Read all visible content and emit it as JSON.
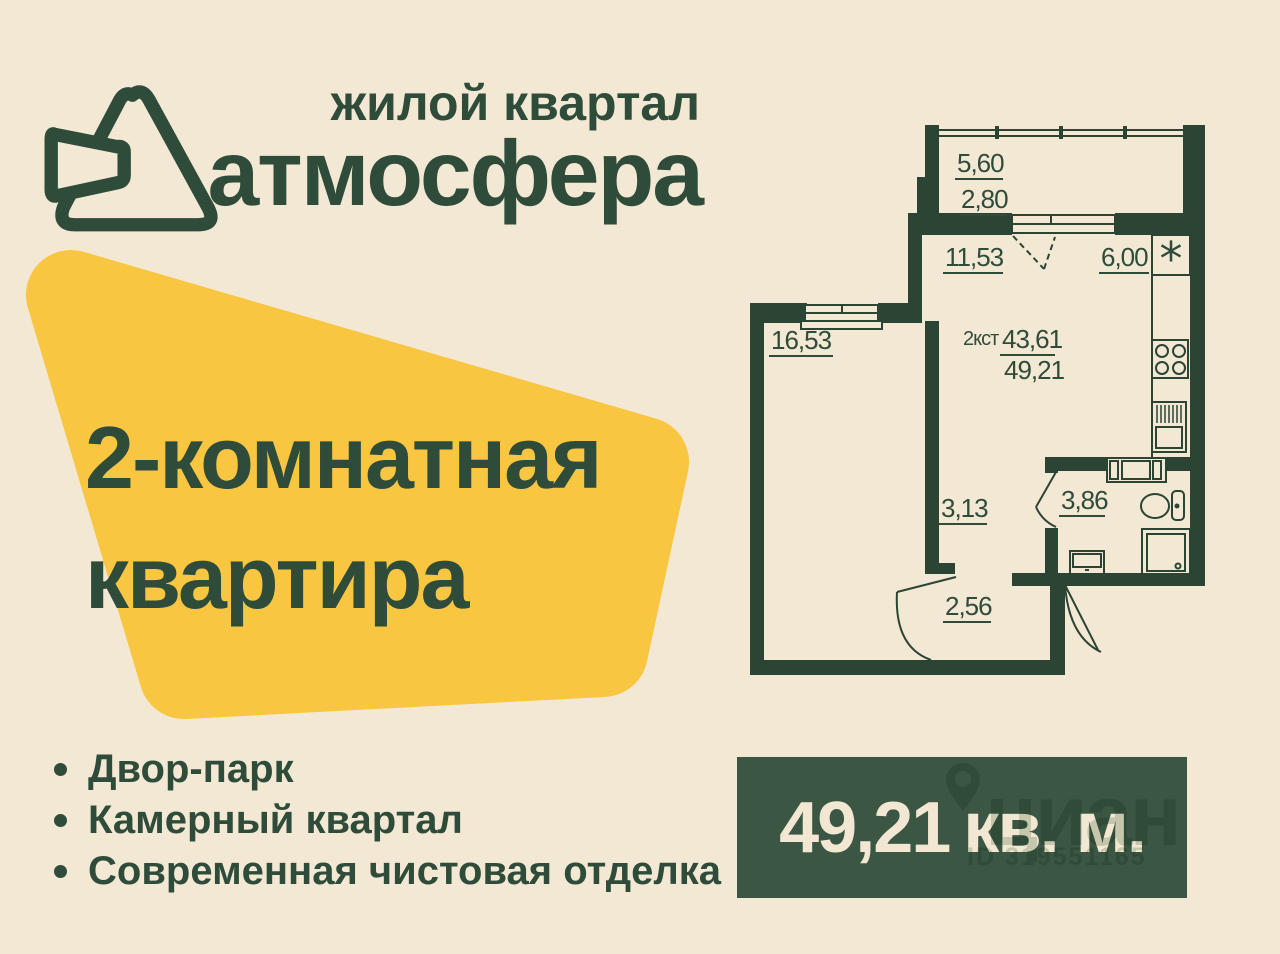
{
  "page": {
    "background": "#f2e8d4",
    "ink": "#2f4b3a"
  },
  "brand": {
    "tagline": "жилой квартал",
    "name": "атмосфера"
  },
  "offer_badge": {
    "color": "#f8c640",
    "line1": "2-комнатная",
    "line2": "квартира"
  },
  "features": {
    "items": [
      "Двор-парк",
      "Камерный квартал",
      "Современная чистовая отделка"
    ]
  },
  "floorplan": {
    "wall_color": "#2b4434",
    "unit_type": "2кст",
    "living_area": "43,61",
    "total_area": "49,21",
    "vent_symbol": "*",
    "labels": {
      "balcony_width": "5,60",
      "balcony_area": "2,80",
      "living_room": "11,53",
      "kitchen": "6,00",
      "bedroom": "16,53",
      "hallway": "3,13",
      "bathroom": "3,86",
      "entry_hall": "2,56"
    }
  },
  "area_panel": {
    "background": "#3b5744",
    "value": "49,21",
    "unit": "кв. м.",
    "watermark": {
      "site": "циан",
      "listing_id": "ID 319551165",
      "icon": "map-pin-icon"
    }
  }
}
